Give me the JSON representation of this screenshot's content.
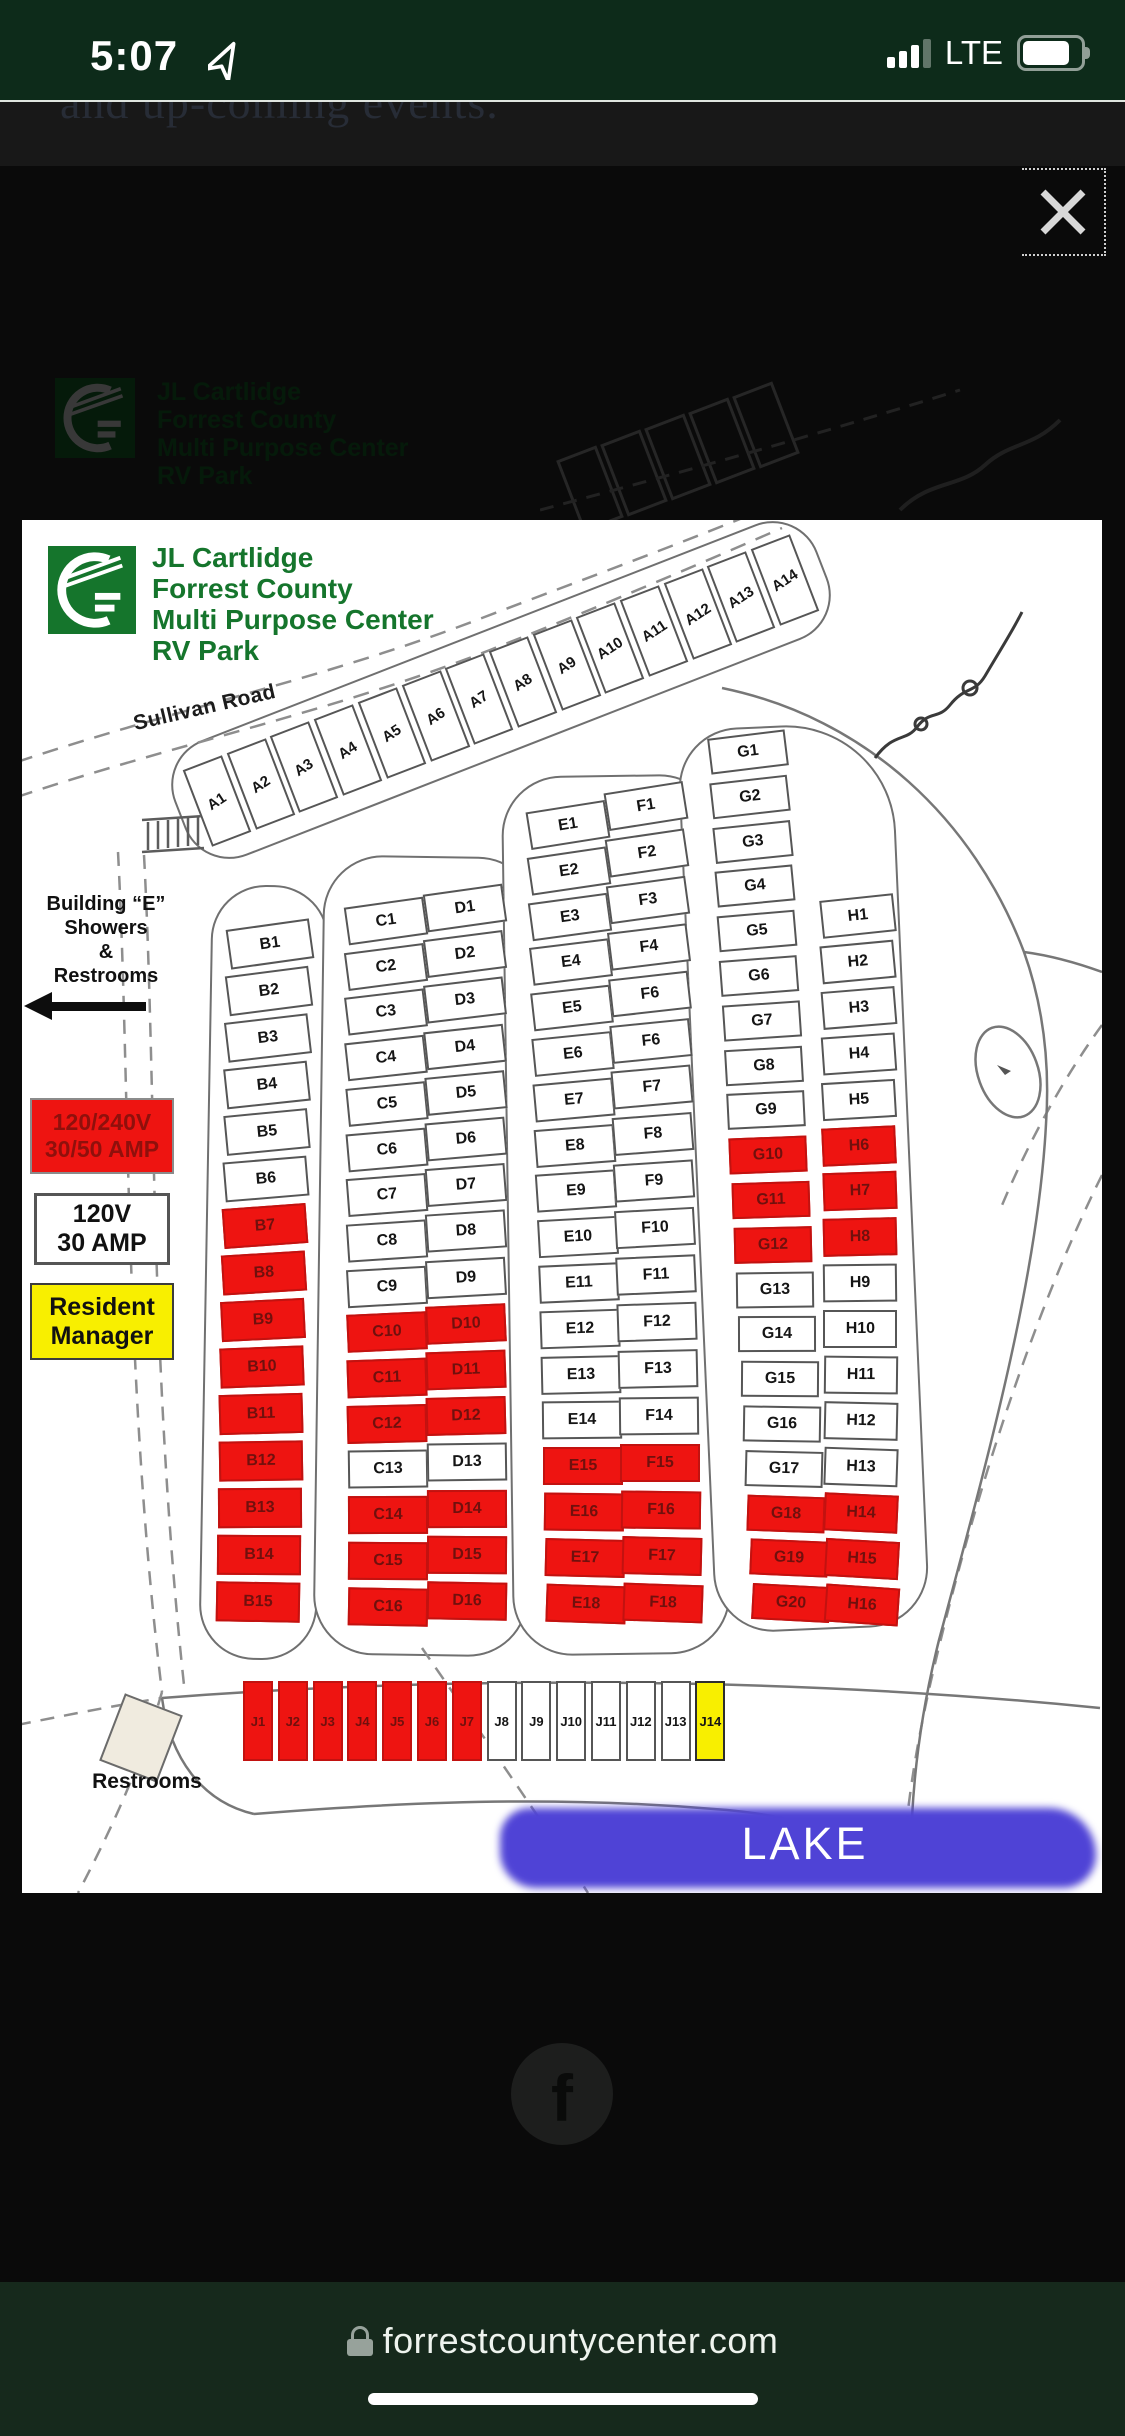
{
  "status_bar": {
    "time": "5:07",
    "network": "LTE"
  },
  "top_page": {
    "partial_text": "and up-coming events."
  },
  "overlay": {
    "close_icon": "×"
  },
  "icons": {
    "close": "x-cross",
    "lock": "padlock",
    "location": "navigation-arrow",
    "signal": "signal-bars-3-of-4",
    "battery": "battery-full",
    "facebook": "facebook-f"
  },
  "map": {
    "title_lines": [
      "JL Cartlidge",
      "Forrest County",
      "Multi Purpose Center",
      "RV Park"
    ],
    "road_label": "Sullivan Road",
    "building_e": {
      "lines": [
        "Building “E”",
        "Showers",
        "&",
        "Restrooms"
      ]
    },
    "legend": {
      "premium": {
        "line1": "120/240V",
        "line2": "30/50 AMP"
      },
      "standard": {
        "line1": "120V",
        "line2": "30 AMP"
      },
      "manager": {
        "line1": "Resident",
        "line2": "Manager"
      }
    },
    "restrooms_label": "Restrooms",
    "lake_label": "LAKE",
    "colors": {
      "premium": "#ee1411",
      "standard": "#ffffff",
      "manager": "#f8ef00",
      "brand_green": "#15752c",
      "lake": "#4f43d6"
    },
    "site_groups": [
      {
        "name": "A",
        "slots": [
          {
            "label": "A1",
            "type": "std"
          },
          {
            "label": "A2",
            "type": "std"
          },
          {
            "label": "A3",
            "type": "std"
          },
          {
            "label": "A4",
            "type": "std"
          },
          {
            "label": "A5",
            "type": "std"
          },
          {
            "label": "A6",
            "type": "std"
          },
          {
            "label": "A7",
            "type": "std"
          },
          {
            "label": "A8",
            "type": "std"
          },
          {
            "label": "A9",
            "type": "std"
          },
          {
            "label": "A10",
            "type": "std"
          },
          {
            "label": "A11",
            "type": "std"
          },
          {
            "label": "A12",
            "type": "std"
          },
          {
            "label": "A13",
            "type": "std"
          },
          {
            "label": "A14",
            "type": "std"
          }
        ]
      },
      {
        "name": "B",
        "slots": [
          {
            "label": "B1",
            "type": "std"
          },
          {
            "label": "B2",
            "type": "std"
          },
          {
            "label": "B3",
            "type": "std"
          },
          {
            "label": "B4",
            "type": "std"
          },
          {
            "label": "B5",
            "type": "std"
          },
          {
            "label": "B6",
            "type": "std"
          },
          {
            "label": "B7",
            "type": "prem"
          },
          {
            "label": "B8",
            "type": "prem"
          },
          {
            "label": "B9",
            "type": "prem"
          },
          {
            "label": "B10",
            "type": "prem"
          },
          {
            "label": "B11",
            "type": "prem"
          },
          {
            "label": "B12",
            "type": "prem"
          },
          {
            "label": "B13",
            "type": "prem"
          },
          {
            "label": "B14",
            "type": "prem"
          },
          {
            "label": "B15",
            "type": "prem"
          }
        ]
      },
      {
        "name": "C",
        "slots": [
          {
            "label": "C1",
            "type": "std"
          },
          {
            "label": "C2",
            "type": "std"
          },
          {
            "label": "C3",
            "type": "std"
          },
          {
            "label": "C4",
            "type": "std"
          },
          {
            "label": "C5",
            "type": "std"
          },
          {
            "label": "C6",
            "type": "std"
          },
          {
            "label": "C7",
            "type": "std"
          },
          {
            "label": "C8",
            "type": "std"
          },
          {
            "label": "C9",
            "type": "std"
          },
          {
            "label": "C10",
            "type": "prem"
          },
          {
            "label": "C11",
            "type": "prem"
          },
          {
            "label": "C12",
            "type": "prem"
          },
          {
            "label": "C13",
            "type": "std"
          },
          {
            "label": "C14",
            "type": "prem"
          },
          {
            "label": "C15",
            "type": "prem"
          },
          {
            "label": "C16",
            "type": "prem"
          }
        ]
      },
      {
        "name": "D",
        "slots": [
          {
            "label": "D1",
            "type": "std"
          },
          {
            "label": "D2",
            "type": "std"
          },
          {
            "label": "D3",
            "type": "std"
          },
          {
            "label": "D4",
            "type": "std"
          },
          {
            "label": "D5",
            "type": "std"
          },
          {
            "label": "D6",
            "type": "std"
          },
          {
            "label": "D7",
            "type": "std"
          },
          {
            "label": "D8",
            "type": "std"
          },
          {
            "label": "D9",
            "type": "std"
          },
          {
            "label": "D10",
            "type": "prem"
          },
          {
            "label": "D11",
            "type": "prem"
          },
          {
            "label": "D12",
            "type": "prem"
          },
          {
            "label": "D13",
            "type": "std"
          },
          {
            "label": "D14",
            "type": "prem"
          },
          {
            "label": "D15",
            "type": "prem"
          },
          {
            "label": "D16",
            "type": "prem"
          }
        ]
      },
      {
        "name": "E",
        "slots": [
          {
            "label": "E1",
            "type": "std"
          },
          {
            "label": "E2",
            "type": "std"
          },
          {
            "label": "E3",
            "type": "std"
          },
          {
            "label": "E4",
            "type": "std"
          },
          {
            "label": "E5",
            "type": "std"
          },
          {
            "label": "E6",
            "type": "std"
          },
          {
            "label": "E7",
            "type": "std"
          },
          {
            "label": "E8",
            "type": "std"
          },
          {
            "label": "E9",
            "type": "std"
          },
          {
            "label": "E10",
            "type": "std"
          },
          {
            "label": "E11",
            "type": "std"
          },
          {
            "label": "E12",
            "type": "std"
          },
          {
            "label": "E13",
            "type": "std"
          },
          {
            "label": "E14",
            "type": "std"
          },
          {
            "label": "E15",
            "type": "prem"
          },
          {
            "label": "E16",
            "type": "prem"
          },
          {
            "label": "E17",
            "type": "prem"
          },
          {
            "label": "E18",
            "type": "prem"
          }
        ]
      },
      {
        "name": "F",
        "slots": [
          {
            "label": "F1",
            "type": "std"
          },
          {
            "label": "F2",
            "type": "std"
          },
          {
            "label": "F3",
            "type": "std"
          },
          {
            "label": "F4",
            "type": "std"
          },
          {
            "label": "F6",
            "type": "std"
          },
          {
            "label": "F6",
            "type": "std"
          },
          {
            "label": "F7",
            "type": "std"
          },
          {
            "label": "F8",
            "type": "std"
          },
          {
            "label": "F9",
            "type": "std"
          },
          {
            "label": "F10",
            "type": "std"
          },
          {
            "label": "F11",
            "type": "std"
          },
          {
            "label": "F12",
            "type": "std"
          },
          {
            "label": "F13",
            "type": "std"
          },
          {
            "label": "F14",
            "type": "std"
          },
          {
            "label": "F15",
            "type": "prem"
          },
          {
            "label": "F16",
            "type": "prem"
          },
          {
            "label": "F17",
            "type": "prem"
          },
          {
            "label": "F18",
            "type": "prem"
          }
        ]
      },
      {
        "name": "G",
        "slots": [
          {
            "label": "G1",
            "type": "std"
          },
          {
            "label": "G2",
            "type": "std"
          },
          {
            "label": "G3",
            "type": "std"
          },
          {
            "label": "G4",
            "type": "std"
          },
          {
            "label": "G5",
            "type": "std"
          },
          {
            "label": "G6",
            "type": "std"
          },
          {
            "label": "G7",
            "type": "std"
          },
          {
            "label": "G8",
            "type": "std"
          },
          {
            "label": "G9",
            "type": "std"
          },
          {
            "label": "G10",
            "type": "prem"
          },
          {
            "label": "G11",
            "type": "prem"
          },
          {
            "label": "G12",
            "type": "prem"
          },
          {
            "label": "G13",
            "type": "std"
          },
          {
            "label": "G14",
            "type": "std"
          },
          {
            "label": "G15",
            "type": "std"
          },
          {
            "label": "G16",
            "type": "std"
          },
          {
            "label": "G17",
            "type": "std"
          },
          {
            "label": "G18",
            "type": "prem"
          },
          {
            "label": "G19",
            "type": "prem"
          },
          {
            "label": "G20",
            "type": "prem"
          }
        ]
      },
      {
        "name": "H",
        "slots": [
          {
            "label": "H1",
            "type": "std"
          },
          {
            "label": "H2",
            "type": "std"
          },
          {
            "label": "H3",
            "type": "std"
          },
          {
            "label": "H4",
            "type": "std"
          },
          {
            "label": "H5",
            "type": "std"
          },
          {
            "label": "H6",
            "type": "prem"
          },
          {
            "label": "H7",
            "type": "prem"
          },
          {
            "label": "H8",
            "type": "prem"
          },
          {
            "label": "H9",
            "type": "std"
          },
          {
            "label": "H10",
            "type": "std"
          },
          {
            "label": "H11",
            "type": "std"
          },
          {
            "label": "H12",
            "type": "std"
          },
          {
            "label": "H13",
            "type": "std"
          },
          {
            "label": "H14",
            "type": "prem"
          },
          {
            "label": "H15",
            "type": "prem"
          },
          {
            "label": "H16",
            "type": "prem"
          }
        ]
      },
      {
        "name": "J",
        "slots": [
          {
            "label": "J1",
            "type": "prem"
          },
          {
            "label": "J2",
            "type": "prem"
          },
          {
            "label": "J3",
            "type": "prem"
          },
          {
            "label": "J4",
            "type": "prem"
          },
          {
            "label": "J5",
            "type": "prem"
          },
          {
            "label": "J6",
            "type": "prem"
          },
          {
            "label": "J7",
            "type": "prem"
          },
          {
            "label": "J8",
            "type": "std"
          },
          {
            "label": "J9",
            "type": "std"
          },
          {
            "label": "J10",
            "type": "std"
          },
          {
            "label": "J11",
            "type": "std"
          },
          {
            "label": "J12",
            "type": "std"
          },
          {
            "label": "J13",
            "type": "std"
          },
          {
            "label": "J14",
            "type": "mgr"
          }
        ]
      }
    ]
  },
  "footer": {
    "url": "forrestcountycenter.com"
  },
  "social": {
    "facebook_label": "f"
  }
}
